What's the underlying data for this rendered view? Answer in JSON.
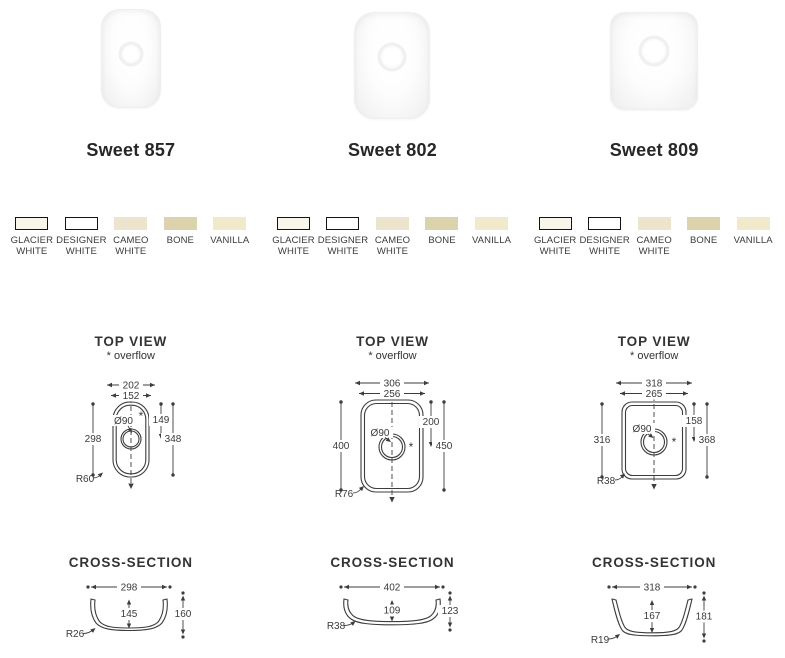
{
  "colors": {
    "line": "#3d3d3d",
    "text": "#3a3a3a",
    "swatch_border": "#141414"
  },
  "sections": {
    "top_view_title": "TOP VIEW",
    "overflow_note": "* overflow",
    "cross_section_title": "CROSS-SECTION"
  },
  "swatches": [
    {
      "label": "GLACIER WHITE",
      "color": "#f8f6eb",
      "bordered": true
    },
    {
      "label": "DESIGNER WHITE",
      "color": "#ffffff",
      "bordered": true
    },
    {
      "label": "CAMEO WHITE",
      "color": "#ece4cd",
      "bordered": false
    },
    {
      "label": "BONE",
      "color": "#dcd2ae",
      "bordered": false
    },
    {
      "label": "VANILLA",
      "color": "#f0eacb",
      "bordered": false
    }
  ],
  "products": [
    {
      "name": "Sweet 857",
      "top_view": {
        "outer_width": "202",
        "inner_width": "152",
        "inner_length": "298",
        "outer_length": "348",
        "drain_distance": "149",
        "drain": "Ø90",
        "radius": "R60"
      },
      "cross_section": {
        "width": "298",
        "inner_depth": "145",
        "outer_depth": "160",
        "radius": "R26"
      }
    },
    {
      "name": "Sweet 802",
      "top_view": {
        "outer_width": "306",
        "inner_width": "256",
        "inner_length": "400",
        "outer_length": "450",
        "drain_distance": "200",
        "drain": "Ø90",
        "radius": "R76"
      },
      "cross_section": {
        "width": "402",
        "inner_depth": "109",
        "outer_depth": "123",
        "radius": "R38"
      }
    },
    {
      "name": "Sweet 809",
      "top_view": {
        "outer_width": "318",
        "inner_width": "265",
        "inner_length": "316",
        "outer_length": "368",
        "drain_distance": "158",
        "drain": "Ø90",
        "radius": "R38"
      },
      "cross_section": {
        "width": "318",
        "inner_depth": "167",
        "outer_depth": "181",
        "radius": "R19"
      }
    }
  ]
}
